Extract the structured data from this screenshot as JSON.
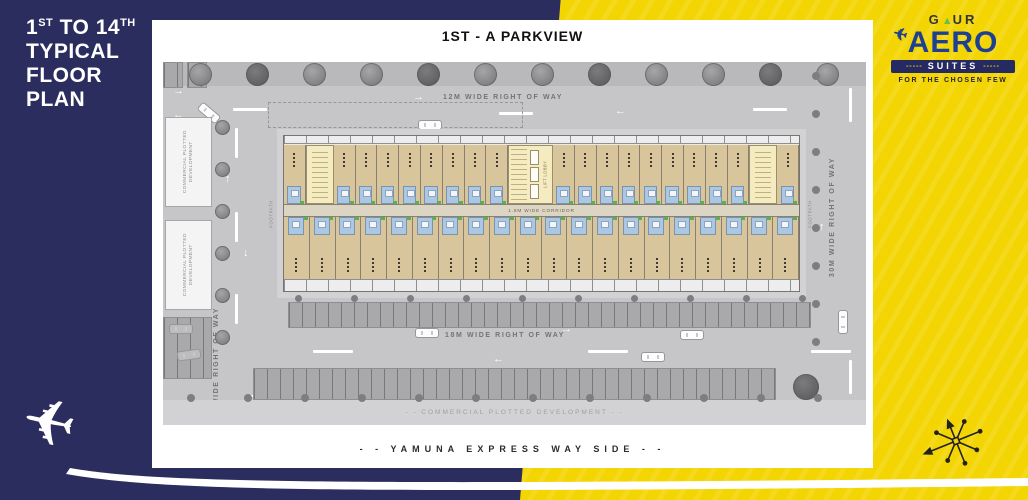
{
  "left_panel": {
    "t1": "1",
    "t1s": "ST",
    "t2": " TO 14",
    "t2s": "TH",
    "l2": "TYPICAL",
    "l3": "FLOOR",
    "l4": "PLAN"
  },
  "brand": {
    "g": "G",
    "tri": "▲",
    "ur": "UR",
    "aero": "AERO",
    "plane": "✈",
    "dash_left": "-----",
    "suites": "SUITES",
    "dash_right": "-----",
    "tagline": "FOR THE CHOSEN FEW"
  },
  "plan": {
    "title": "1ST - A  PARKVIEW",
    "road_top": "12M WIDE RIGHT OF WAY",
    "road_bottom": "18M WIDE RIGHT OF WAY",
    "road_left": "9M WIDE RIGHT OF WAY",
    "road_right": "30M WIDE RIGHT OF WAY",
    "corridor": "1.8M WIDE CORRIDOR",
    "lift_lobby": "LIFT LOBBY",
    "footpath": "FOOTPATH",
    "commercial_plot": "COMMERCIAL PLOTTED DEVELOPMENT",
    "commercial_strip": "- - COMMERCIAL  PLOTTED  DEVELOPMENT - -",
    "yamuna": "- - YAMUNA  EXPRESS  WAY  SIDE - -",
    "building": {
      "top_left_units": 8,
      "top_right_units": 9,
      "bottom_units": 20,
      "end_units": 1
    }
  },
  "colors": {
    "navy": "#2b2d5f",
    "yellow": "#f3d503",
    "logo_blue": "#1d3f94",
    "logo_green": "#6abf4b",
    "unit_tan": "#d8c59c",
    "bath_blue": "#aac8e3",
    "stair_yellow": "#f5ebc1",
    "site_gray": "#c6c6c8",
    "parking_gray": "#a9a9ab"
  }
}
